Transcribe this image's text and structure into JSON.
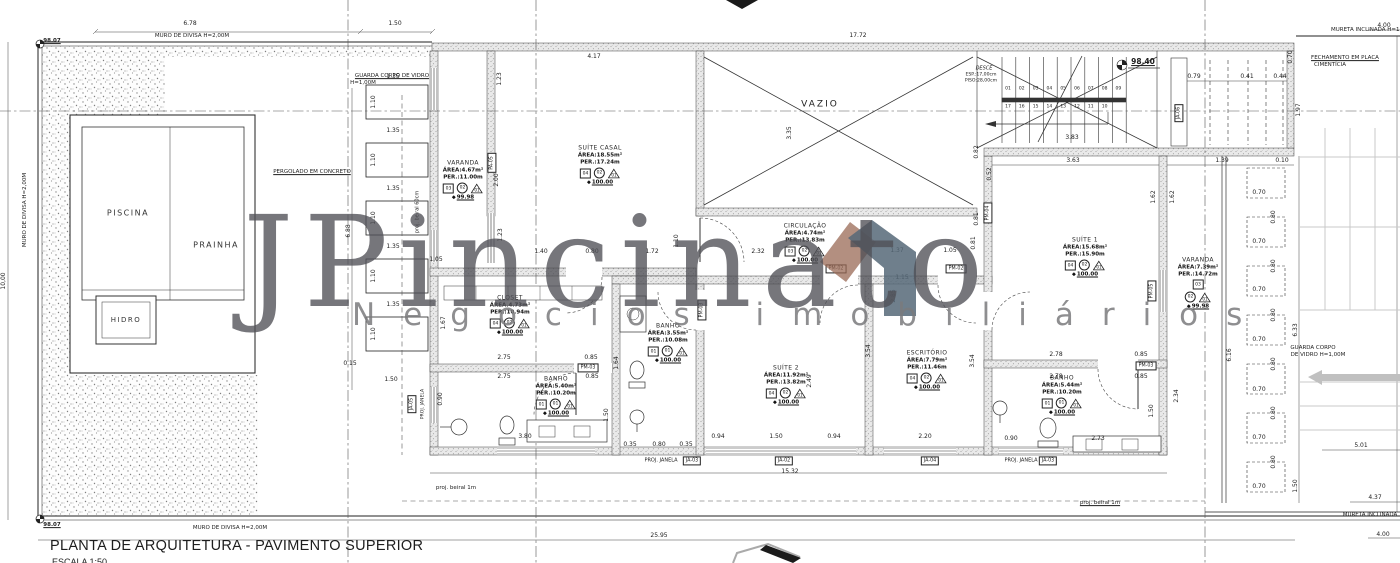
{
  "title": {
    "main": "PLANTA DE ARQUITETURA - PAVIMENTO SUPERIOR",
    "scale": "ESCALA 1:50"
  },
  "watermark": {
    "brand": "JPincinato",
    "tagline": "Negócios imobiliários",
    "roof_color": "#566878",
    "roof_accent": "#9a6a55"
  },
  "pool": {
    "piscina": "PISCINA",
    "prainha": "PRAINHA",
    "hidro": "HIDRO"
  },
  "stair": {
    "desce": "DESCE",
    "esp": "ESP.:17,00cm",
    "piso": "PISO:28,00cm",
    "steps_top": [
      "01",
      "02",
      "03",
      "04",
      "05",
      "06",
      "07",
      "08",
      "09"
    ],
    "steps_bottom": [
      "17",
      "16",
      "15",
      "14",
      "13",
      "12",
      "11",
      "10"
    ],
    "level": "98.40"
  },
  "rooms": [
    {
      "id": "varanda-esq",
      "name": "VARANDA",
      "area": "ÁREA:4.67m²",
      "per": "PER.:11.00m",
      "tags": [
        {
          "s": "sq",
          "v": "03"
        },
        {
          "s": "ci",
          "v": "02"
        },
        {
          "s": "tr",
          "v": "01"
        }
      ],
      "level": "99.98",
      "cx": 463,
      "cy": 180
    },
    {
      "id": "suite-casal",
      "name": "SUÍTE CASAL",
      "area": "ÁREA:18.55m²",
      "per": "PER.:17.24m",
      "tags": [
        {
          "s": "sq",
          "v": "04"
        },
        {
          "s": "ci",
          "v": "02"
        },
        {
          "s": "tr",
          "v": "01"
        }
      ],
      "level": "100.00",
      "cx": 600,
      "cy": 165
    },
    {
      "id": "circulacao",
      "name": "CIRCULAÇÃO",
      "area": "ÁREA:4.74m²",
      "per": "PER.:13.83m",
      "tags": [
        {
          "s": "sq",
          "v": "03"
        },
        {
          "s": "ci",
          "v": "02"
        },
        {
          "s": "tr",
          "v": "01"
        }
      ],
      "level": "100.00",
      "cx": 805,
      "cy": 243
    },
    {
      "id": "closet",
      "name": "CLOSET",
      "area": "ÁREA:4.73m²",
      "per": "PER.:10.94m",
      "tags": [
        {
          "s": "sq",
          "v": "04"
        },
        {
          "s": "ci",
          "v": "02"
        },
        {
          "s": "tr",
          "v": "01"
        }
      ],
      "level": "100.00",
      "cx": 510,
      "cy": 315
    },
    {
      "id": "banho-1",
      "name": "BANHO",
      "area": "ÁREA:5.40m²",
      "per": "PER.:10.20m",
      "tags": [
        {
          "s": "sq",
          "v": "01"
        },
        {
          "s": "ci",
          "v": "01"
        },
        {
          "s": "tr",
          "v": "01"
        }
      ],
      "level": "100.00",
      "cx": 556,
      "cy": 396
    },
    {
      "id": "banho-2",
      "name": "BANHO",
      "area": "ÁREA:3.55m²",
      "per": "PER.:10.08m",
      "tags": [
        {
          "s": "sq",
          "v": "01"
        },
        {
          "s": "ci",
          "v": "01"
        },
        {
          "s": "tr",
          "v": "01"
        }
      ],
      "level": "100.00",
      "cx": 668,
      "cy": 343
    },
    {
      "id": "suite-2",
      "name": "SUÍTE 2",
      "area": "ÁREA:11.92m²",
      "per": "PER.:13.82m",
      "tags": [
        {
          "s": "sq",
          "v": "04"
        },
        {
          "s": "ci",
          "v": "02"
        },
        {
          "s": "tr",
          "v": "01"
        }
      ],
      "level": "100.00",
      "cx": 786,
      "cy": 385
    },
    {
      "id": "escritorio",
      "name": "ESCRITÓRIO",
      "area": "ÁREA:7.79m²",
      "per": "PER.:11.46m",
      "tags": [
        {
          "s": "sq",
          "v": "04"
        },
        {
          "s": "ci",
          "v": "02"
        },
        {
          "s": "tr",
          "v": "01"
        }
      ],
      "level": "100.00",
      "cx": 927,
      "cy": 370
    },
    {
      "id": "banho-3",
      "name": "BANHO",
      "area": "ÁREA:5.44m²",
      "per": "PER.:10.20m",
      "tags": [
        {
          "s": "sq",
          "v": "01"
        },
        {
          "s": "ci",
          "v": "01"
        },
        {
          "s": "tr",
          "v": "01"
        }
      ],
      "level": "100.00",
      "cx": 1062,
      "cy": 395
    },
    {
      "id": "suite-1",
      "name": "SUÍTE 1",
      "area": "ÁREA:15.68m²",
      "per": "PER.:15.90m",
      "tags": [
        {
          "s": "sq",
          "v": "04"
        },
        {
          "s": "ci",
          "v": "02"
        },
        {
          "s": "tr",
          "v": "01"
        }
      ],
      "level": "100.00",
      "cx": 1085,
      "cy": 257
    },
    {
      "id": "varanda-dir",
      "name": "VARANDA",
      "area": "ÁREA:7.39m²",
      "per": "PER.:14.72m",
      "tags": [
        {
          "s": "sq",
          "v": "03"
        },
        {
          "s": "ci",
          "v": "02"
        },
        {
          "s": "tr",
          "v": "01"
        }
      ],
      "level": "99.98",
      "cx": 1198,
      "cy": 283,
      "stack": true
    }
  ],
  "levels": [
    {
      "t": "98.07",
      "x": 52,
      "y": 42,
      "fs": 5.5
    },
    {
      "t": "98.07",
      "x": 52,
      "y": 526,
      "fs": 5.5
    },
    {
      "t": "98.40",
      "x": 1143,
      "y": 62,
      "fs": 7.5
    }
  ],
  "notes": [
    {
      "t": "MURO DE DIVISA H=2,00M",
      "x": 192,
      "y": 37,
      "fs": 5.5
    },
    {
      "t": "MURO DE DIVISA H=2,00M",
      "x": 26,
      "y": 210,
      "r": -90,
      "fs": 5.5
    },
    {
      "t": "MURO DE DIVISA H=2,00M",
      "x": 230,
      "y": 529,
      "fs": 5.5
    },
    {
      "t": "GUARDA CORPO DE VIDRO",
      "x": 392,
      "y": 77,
      "fs": 5.5,
      "u": true
    },
    {
      "t": "H=1,00M",
      "x": 363,
      "y": 84,
      "fs": 5.5
    },
    {
      "t": "PERGOLADO EM CONCRETO",
      "x": 312,
      "y": 173,
      "fs": 5.5,
      "u": true
    },
    {
      "t": "proj. beiral 60cm",
      "x": 418,
      "y": 212,
      "r": -90,
      "fs": 5
    },
    {
      "t": "VAZIO",
      "x": 820,
      "y": 105,
      "fs": 9,
      "sp": 2
    },
    {
      "t": "FECHAMENTO EM PLACA",
      "x": 1345,
      "y": 59,
      "fs": 5.5,
      "u": true
    },
    {
      "t": "CIMENTÍCIA",
      "x": 1330,
      "y": 66,
      "fs": 5.5
    },
    {
      "t": "MURETA INCLINADA H=1,00M",
      "x": 1372,
      "y": 31,
      "fs": 5.5
    },
    {
      "t": "MURETA INCLINADA",
      "x": 1370,
      "y": 516,
      "fs": 5.5
    },
    {
      "t": "GUARDA CORPO",
      "x": 1313,
      "y": 349,
      "fs": 5.5
    },
    {
      "t": "DE VIDRO H=1,00M",
      "x": 1318,
      "y": 356,
      "fs": 5.5
    },
    {
      "t": "PROJ. JANELA",
      "x": 661,
      "y": 461,
      "fs": 5
    },
    {
      "t": "PROJ. JANELA",
      "x": 1021,
      "y": 461,
      "fs": 5
    },
    {
      "t": "PROJ. JANELA",
      "x": 424,
      "y": 404,
      "r": -90,
      "fs": 4.6
    },
    {
      "t": "proj. beiral 1m",
      "x": 456,
      "y": 489,
      "fs": 5.5
    },
    {
      "t": "proj. beiral 1m",
      "x": 1100,
      "y": 504,
      "fs": 5.5,
      "u": true
    }
  ],
  "boxtags": [
    {
      "t": "JA-03",
      "x": 692,
      "y": 461
    },
    {
      "t": "JA-02",
      "x": 784,
      "y": 461
    },
    {
      "t": "JA-04",
      "x": 930,
      "y": 461
    },
    {
      "t": "JA-03",
      "x": 1048,
      "y": 461
    },
    {
      "t": "JA-05",
      "x": 412,
      "y": 404,
      "r": -90
    },
    {
      "t": "PA-05",
      "x": 492,
      "y": 163,
      "r": -90
    },
    {
      "t": "PM-04",
      "x": 988,
      "y": 213,
      "r": -90
    },
    {
      "t": "PM-05",
      "x": 1152,
      "y": 291,
      "r": -90
    },
    {
      "t": "PM-02",
      "x": 836,
      "y": 269
    },
    {
      "t": "PM-02",
      "x": 956,
      "y": 269
    },
    {
      "t": "PM-03",
      "x": 588,
      "y": 368
    },
    {
      "t": "PM-03",
      "x": 702,
      "y": 310,
      "r": -90
    },
    {
      "t": "PM-03",
      "x": 1146,
      "y": 366
    },
    {
      "t": "JA-06",
      "x": 1179,
      "y": 113,
      "r": -90
    }
  ],
  "dims": [
    {
      "t": "6.78",
      "x": 190,
      "y": 24
    },
    {
      "t": "1.50",
      "x": 395,
      "y": 24
    },
    {
      "t": "17.72",
      "x": 858,
      "y": 36
    },
    {
      "t": "4.00",
      "x": 1384,
      "y": 26
    },
    {
      "t": "10,00",
      "x": 4,
      "y": 281,
      "r": -90
    },
    {
      "t": "6.88",
      "x": 349,
      "y": 231,
      "r": -90
    },
    {
      "t": "0.15",
      "x": 350,
      "y": 364
    },
    {
      "t": "1.50",
      "x": 391,
      "y": 380
    },
    {
      "t": "1.05",
      "x": 436,
      "y": 260
    },
    {
      "t": "1.35",
      "x": 393,
      "y": 77
    },
    {
      "t": "1.10",
      "x": 374,
      "y": 102,
      "r": -90
    },
    {
      "t": "1.35",
      "x": 393,
      "y": 131
    },
    {
      "t": "1.10",
      "x": 374,
      "y": 160,
      "r": -90
    },
    {
      "t": "1.35",
      "x": 393,
      "y": 189
    },
    {
      "t": "1.10",
      "x": 374,
      "y": 218,
      "r": -90
    },
    {
      "t": "1.35",
      "x": 393,
      "y": 247
    },
    {
      "t": "1.10",
      "x": 374,
      "y": 276,
      "r": -90
    },
    {
      "t": "1.35",
      "x": 393,
      "y": 305
    },
    {
      "t": "1.10",
      "x": 374,
      "y": 334,
      "r": -90
    },
    {
      "t": "4.17",
      "x": 594,
      "y": 57
    },
    {
      "t": "1.23",
      "x": 500,
      "y": 79,
      "r": -90
    },
    {
      "t": "1.23",
      "x": 501,
      "y": 235,
      "r": -90
    },
    {
      "t": "2.00",
      "x": 497,
      "y": 180,
      "r": -90
    },
    {
      "t": "1.40",
      "x": 541,
      "y": 252
    },
    {
      "t": "0.80",
      "x": 592,
      "y": 252
    },
    {
      "t": "1.72",
      "x": 652,
      "y": 252
    },
    {
      "t": "1.10",
      "x": 677,
      "y": 241,
      "r": -90
    },
    {
      "t": "2.32",
      "x": 758,
      "y": 252
    },
    {
      "t": "3.35",
      "x": 790,
      "y": 133,
      "r": -90
    },
    {
      "t": "1.37",
      "x": 897,
      "y": 251
    },
    {
      "t": "1.05",
      "x": 950,
      "y": 251
    },
    {
      "t": "1.15",
      "x": 902,
      "y": 278
    },
    {
      "t": "0.81",
      "x": 974,
      "y": 243,
      "r": -90
    },
    {
      "t": "2.85",
      "x": 894,
      "y": 296,
      "r": -90
    },
    {
      "t": "3.83",
      "x": 1072,
      "y": 138
    },
    {
      "t": "3.63",
      "x": 1073,
      "y": 161
    },
    {
      "t": "1.39",
      "x": 1222,
      "y": 161
    },
    {
      "t": "0.10",
      "x": 1282,
      "y": 161
    },
    {
      "t": "0.79",
      "x": 1194,
      "y": 77
    },
    {
      "t": "0.41",
      "x": 1247,
      "y": 77
    },
    {
      "t": "0.44",
      "x": 1280,
      "y": 77
    },
    {
      "t": "1.97",
      "x": 1299,
      "y": 110,
      "r": -90
    },
    {
      "t": "0.70",
      "x": 1291,
      "y": 57,
      "r": -90
    },
    {
      "t": "0.82",
      "x": 977,
      "y": 152,
      "r": -90
    },
    {
      "t": "0.52",
      "x": 990,
      "y": 174,
      "r": -90
    },
    {
      "t": "0.81",
      "x": 977,
      "y": 219,
      "r": -90
    },
    {
      "t": "1.62",
      "x": 1154,
      "y": 197,
      "r": -90
    },
    {
      "t": "1.62",
      "x": 1173,
      "y": 197,
      "r": -90
    },
    {
      "t": "2.78",
      "x": 1056,
      "y": 355
    },
    {
      "t": "0.85",
      "x": 1141,
      "y": 355
    },
    {
      "t": "2.78",
      "x": 1056,
      "y": 377
    },
    {
      "t": "0.85",
      "x": 1141,
      "y": 377
    },
    {
      "t": "2.34",
      "x": 1177,
      "y": 396,
      "r": -90
    },
    {
      "t": "1.50",
      "x": 1152,
      "y": 411,
      "r": -90
    },
    {
      "t": "1.67",
      "x": 444,
      "y": 323,
      "r": -90
    },
    {
      "t": "2.75",
      "x": 504,
      "y": 358
    },
    {
      "t": "0.85",
      "x": 591,
      "y": 358
    },
    {
      "t": "2.75",
      "x": 504,
      "y": 377
    },
    {
      "t": "0.85",
      "x": 592,
      "y": 377
    },
    {
      "t": "0.90",
      "x": 441,
      "y": 399,
      "r": -90
    },
    {
      "t": "3.80",
      "x": 525,
      "y": 437
    },
    {
      "t": "1.50",
      "x": 607,
      "y": 415,
      "r": -90
    },
    {
      "t": "1.64",
      "x": 617,
      "y": 363,
      "r": -90
    },
    {
      "t": "0.35",
      "x": 630,
      "y": 445
    },
    {
      "t": "0.80",
      "x": 659,
      "y": 445
    },
    {
      "t": "0.35",
      "x": 686,
      "y": 445
    },
    {
      "t": "3.54",
      "x": 869,
      "y": 351,
      "r": -90
    },
    {
      "t": "2.49",
      "x": 810,
      "y": 381,
      "r": -90
    },
    {
      "t": "0.94",
      "x": 718,
      "y": 437
    },
    {
      "t": "1.50",
      "x": 776,
      "y": 437
    },
    {
      "t": "0.94",
      "x": 834,
      "y": 437
    },
    {
      "t": "3.54",
      "x": 973,
      "y": 361,
      "r": -90
    },
    {
      "t": "2.20",
      "x": 925,
      "y": 437
    },
    {
      "t": "0.90",
      "x": 1011,
      "y": 439
    },
    {
      "t": "2.73",
      "x": 1098,
      "y": 439
    },
    {
      "t": "0.70",
      "x": 1259,
      "y": 193
    },
    {
      "t": "0.70",
      "x": 1259,
      "y": 242
    },
    {
      "t": "0.70",
      "x": 1259,
      "y": 290
    },
    {
      "t": "0.70",
      "x": 1259,
      "y": 340
    },
    {
      "t": "0.70",
      "x": 1259,
      "y": 390
    },
    {
      "t": "0.70",
      "x": 1259,
      "y": 438
    },
    {
      "t": "0.70",
      "x": 1259,
      "y": 487
    },
    {
      "t": "0.80",
      "x": 1274,
      "y": 217,
      "r": -90
    },
    {
      "t": "0.80",
      "x": 1274,
      "y": 266,
      "r": -90
    },
    {
      "t": "0.80",
      "x": 1274,
      "y": 315,
      "r": -90
    },
    {
      "t": "0.80",
      "x": 1274,
      "y": 364,
      "r": -90
    },
    {
      "t": "0.80",
      "x": 1274,
      "y": 413,
      "r": -90
    },
    {
      "t": "0.80",
      "x": 1274,
      "y": 462,
      "r": -90
    },
    {
      "t": "6.33",
      "x": 1296,
      "y": 330,
      "r": -90
    },
    {
      "t": "1.50",
      "x": 1296,
      "y": 486,
      "r": -90
    },
    {
      "t": "6.16",
      "x": 1230,
      "y": 355,
      "r": -90
    },
    {
      "t": "5.01",
      "x": 1361,
      "y": 446
    },
    {
      "t": "4.37",
      "x": 1375,
      "y": 498
    },
    {
      "t": "4.00",
      "x": 1383,
      "y": 535
    },
    {
      "t": "15.32",
      "x": 790,
      "y": 472
    },
    {
      "t": "25.95",
      "x": 659,
      "y": 536
    }
  ]
}
